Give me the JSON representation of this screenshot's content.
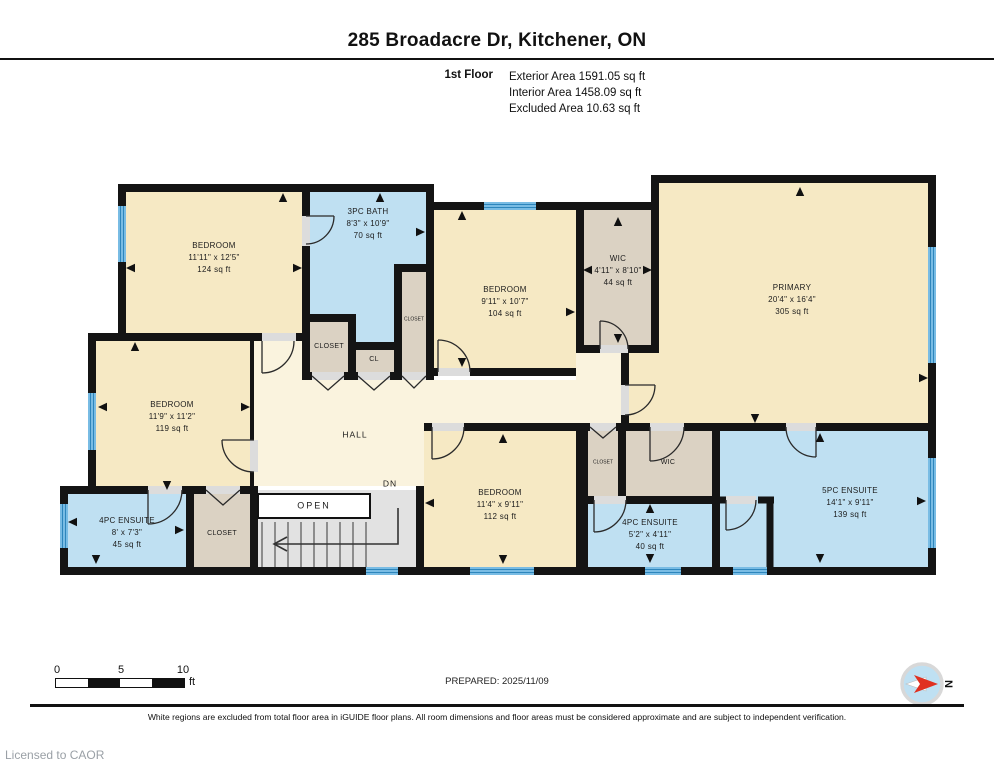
{
  "header": {
    "title": "285 Broadacre Dr, Kitchener, ON",
    "floor": "1st Floor",
    "areas": {
      "exterior": "Exterior Area 1591.05 sq ft",
      "interior": "Interior Area 1458.09 sq ft",
      "excluded": "Excluded Area 10.63 sq ft"
    }
  },
  "rooms": [
    {
      "name": "BEDROOM",
      "dims": "11'11\" x 12'5\"",
      "area": "124 sq ft"
    },
    {
      "name": "3PC BATH",
      "dims": "8'3\" x 10'9\"",
      "area": "70 sq ft"
    },
    {
      "name": "BEDROOM",
      "dims": "9'11\" x 10'7\"",
      "area": "104 sq ft"
    },
    {
      "name": "WIC",
      "dims": "4'11\" x 8'10\"",
      "area": "44 sq ft"
    },
    {
      "name": "PRIMARY",
      "dims": "20'4\" x 16'4\"",
      "area": "305 sq ft"
    },
    {
      "name": "BEDROOM",
      "dims": "11'9\" x 11'2\"",
      "area": "119 sq ft"
    },
    {
      "name": "4PC ENSUITE",
      "dims": "8' x 7'3\"",
      "area": "45 sq ft"
    },
    {
      "name": "BEDROOM",
      "dims": "11'4\" x 9'11\"",
      "area": "112 sq ft"
    },
    {
      "name": "4PC ENSUITE",
      "dims": "5'2\" x 4'11\"",
      "area": "40 sq ft"
    },
    {
      "name": "5PC ENSUITE",
      "dims": "14'1\" x 9'11\"",
      "area": "139 sq ft"
    },
    {
      "name": "WIC"
    },
    {
      "name": "CLOSET"
    },
    {
      "name": "CL"
    },
    {
      "name": "CLOSET"
    },
    {
      "name": "CLOSET"
    },
    {
      "name": "CLOSET"
    },
    {
      "name": "HALL"
    },
    {
      "name": "OPEN"
    },
    {
      "name": "DN"
    }
  ],
  "scale": {
    "ticks": [
      "0",
      "5",
      "10"
    ],
    "unit": "ft"
  },
  "footer": {
    "prepared": "PREPARED: 2025/11/09",
    "disclaimer": "White regions are excluded from total floor area in iGUIDE floor plans. All room dimensions and floor areas must be considered approximate and are subject to independent verification.",
    "license": "Licensed to CAOR",
    "compass_n": "N"
  },
  "colors": {
    "room_beige": "#F6E9C4",
    "hall_cream": "#FAF3DE",
    "wet_blue": "#BFE0F2",
    "closet_tan": "#DBD2C3",
    "stairs_gray": "#E2E2E2",
    "wall_black": "#141414",
    "window_blue": "#79BCE4",
    "window_stripe": "#2E86BC",
    "compass_red": "#E03020"
  }
}
